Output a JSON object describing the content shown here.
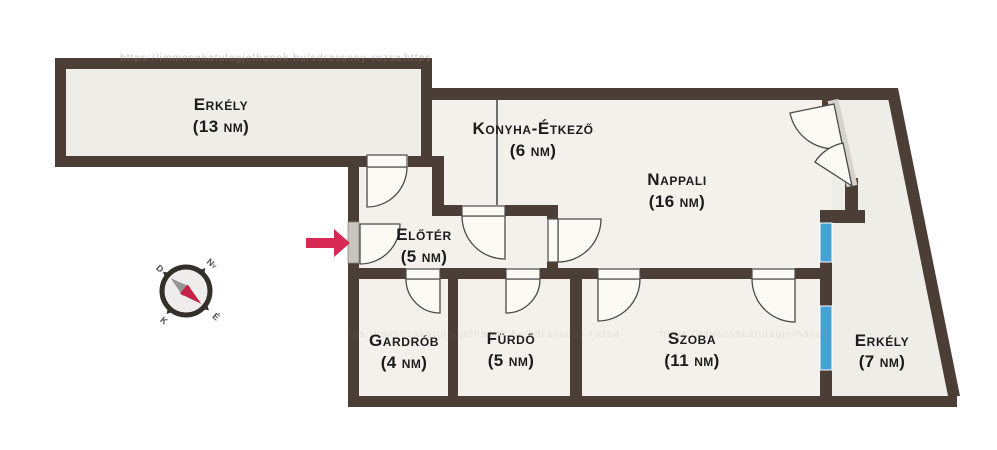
{
  "title": "Apartment floor plan",
  "plan": {
    "rooms": [
      {
        "name": "Erkély",
        "area": "(13 nm)"
      },
      {
        "name": "Konyha-Étkező",
        "area": "(6 nm)"
      },
      {
        "name": "Nappali",
        "area": "(16 nm)"
      },
      {
        "name": "Előtér",
        "area": "(5 nm)"
      },
      {
        "name": "Gardrób",
        "area": "(4 nm)"
      },
      {
        "name": "Fürdő",
        "area": "(5 nm)"
      },
      {
        "name": "Szoba",
        "area": "(11 nm)"
      },
      {
        "name": "Erkély",
        "area": "(7 nm)"
      }
    ],
    "compass": {
      "north": "É",
      "south": "D",
      "east": "K",
      "west": "Ny"
    },
    "watermark": "https://immosakatulagjelhanok.hu/sdracsony-rozsa",
    "colors": {
      "wall": "#4a3e36",
      "room_fill": "#f4f1ed",
      "balcony_fill": "#efede8",
      "window": "#47a2d4",
      "door": "#fcfaf5",
      "entrance_door": "#c9c4bd",
      "arrow": "#d62a55",
      "compass_needle": "#c22347"
    }
  }
}
